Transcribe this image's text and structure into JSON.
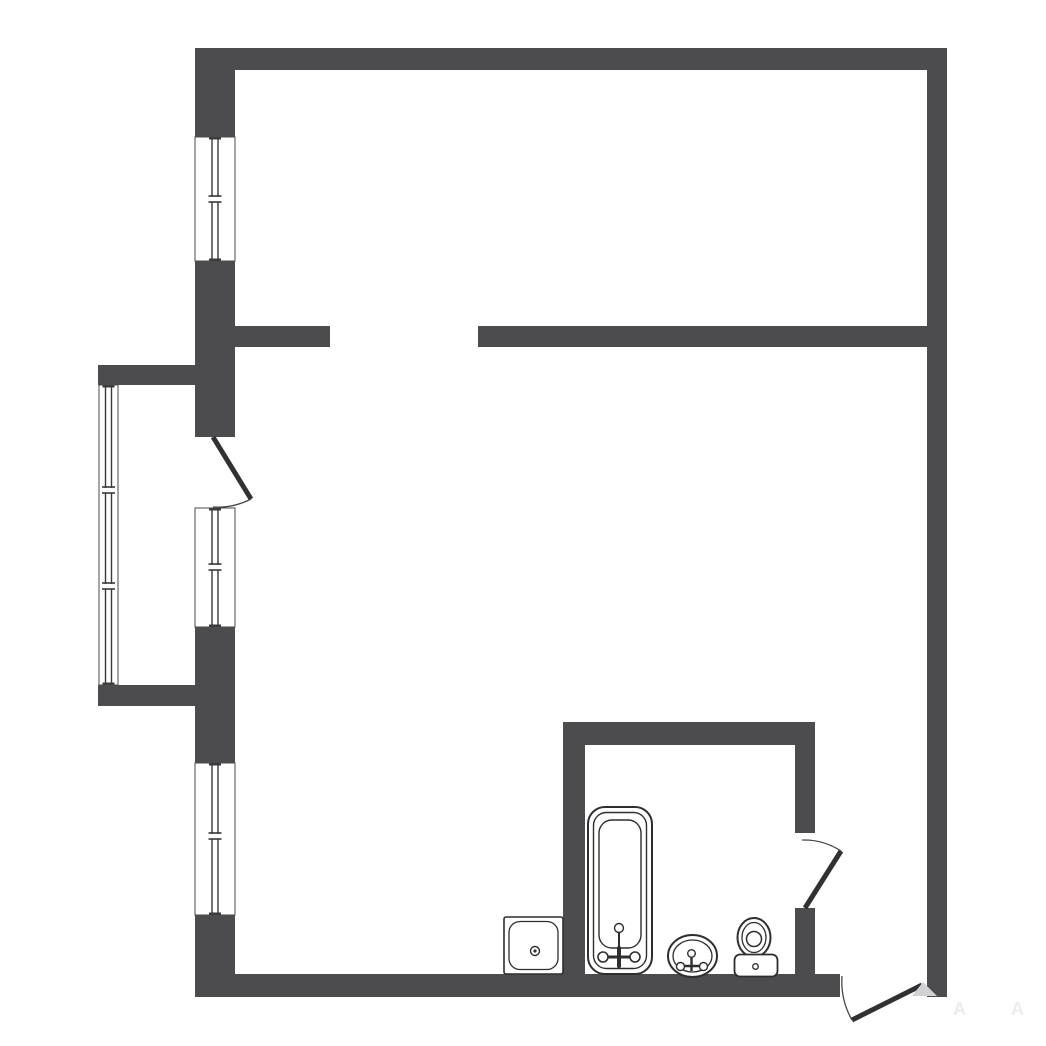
{
  "document": {
    "kind": "apartment-floor-plan",
    "description": "Black-and-white architectural floor plan of a one-room apartment with balcony, bathroom and entrance hall"
  },
  "canvas": {
    "width": 1046,
    "height": 1046,
    "background": "#ffffff"
  },
  "colors": {
    "wall": "#4c4c4e",
    "fixture_line": "#2e2e30",
    "window_line": "#39393b",
    "window_border": "#4a4a4c",
    "door_leaf": "#313133",
    "door_swing": "#47474a",
    "notch": "#d2d2d4",
    "watermark": "#ececec",
    "background": "#ffffff"
  },
  "plan": {
    "walls": [
      {
        "name": "wall-top",
        "x": 195,
        "y": 48,
        "w": 752,
        "h": 22
      },
      {
        "name": "wall-right",
        "x": 927,
        "y": 48,
        "w": 20,
        "h": 949
      },
      {
        "name": "wall-bottom",
        "x": 195,
        "y": 974,
        "w": 645,
        "h": 23
      },
      {
        "name": "wall-left-upper",
        "x": 195,
        "y": 48,
        "w": 40,
        "h": 89
      },
      {
        "name": "wall-left-mid",
        "x": 195,
        "y": 261,
        "w": 40,
        "h": 176
      },
      {
        "name": "wall-left-lower",
        "x": 195,
        "y": 627,
        "w": 40,
        "h": 136
      },
      {
        "name": "wall-left-bottom",
        "x": 195,
        "y": 915,
        "w": 40,
        "h": 82
      },
      {
        "name": "partition-left",
        "x": 235,
        "y": 326,
        "w": 95,
        "h": 21
      },
      {
        "name": "partition-right",
        "x": 478,
        "y": 326,
        "w": 449,
        "h": 21
      },
      {
        "name": "balcony-stub-top",
        "x": 98,
        "y": 365,
        "w": 97,
        "h": 20
      },
      {
        "name": "balcony-stub-bottom",
        "x": 98,
        "y": 685,
        "w": 97,
        "h": 21
      },
      {
        "name": "bathroom-wall-left",
        "x": 563,
        "y": 722,
        "w": 22,
        "h": 252
      },
      {
        "name": "bathroom-wall-top",
        "x": 563,
        "y": 722,
        "w": 252,
        "h": 23
      },
      {
        "name": "bathroom-wall-right-upper",
        "x": 795,
        "y": 722,
        "w": 20,
        "h": 111
      },
      {
        "name": "bathroom-wall-right-lower",
        "x": 795,
        "y": 908,
        "w": 20,
        "h": 66
      }
    ],
    "windows": [
      {
        "name": "window-top-room",
        "x": 195,
        "y": 137,
        "w": 40,
        "h": 124,
        "ticks": [
          196
        ]
      },
      {
        "name": "window-balcony-door",
        "x": 195,
        "y": 508,
        "w": 40,
        "h": 119,
        "ticks": [
          564
        ]
      },
      {
        "name": "window-living-room",
        "x": 195,
        "y": 763,
        "w": 40,
        "h": 152,
        "ticks": [
          833
        ]
      },
      {
        "name": "balcony-glazing",
        "x": 99,
        "y": 385,
        "w": 19,
        "h": 300,
        "ticks": [
          487,
          583
        ]
      }
    ],
    "doors": [
      {
        "name": "balcony-door",
        "hinge": [
          213,
          437
        ],
        "tip": [
          251,
          499
        ],
        "jamb": [
          213,
          507
        ],
        "sweep": 1
      },
      {
        "name": "bathroom-door",
        "hinge": [
          805,
          908
        ],
        "tip": [
          841,
          851
        ],
        "jamb": [
          802,
          840
        ],
        "sweep": 0
      },
      {
        "name": "entrance-door",
        "hinge": [
          922,
          985
        ],
        "tip": [
          852,
          1020
        ],
        "jamb": [
          842,
          976
        ],
        "sweep": 1
      }
    ],
    "door_notch": {
      "name": "entrance-door-notch",
      "points": "912,996 937,996 923,982"
    },
    "fixtures": [
      {
        "name": "kitchen-sink",
        "shapes": [
          {
            "t": "rect",
            "x": 504,
            "y": 917,
            "w": 59,
            "h": 57,
            "rx": 2,
            "sw": 1.6
          },
          {
            "t": "rect",
            "x": 509,
            "y": 921.5,
            "w": 49,
            "h": 48,
            "rx": 11,
            "sw": 1.3
          },
          {
            "t": "circle",
            "cx": 535,
            "cy": 951,
            "r": 4.5,
            "sw": 1.4
          },
          {
            "t": "dot",
            "cx": 535,
            "cy": 951,
            "r": 1.6
          }
        ]
      },
      {
        "name": "bathtub",
        "shapes": [
          {
            "t": "rect",
            "x": 588,
            "y": 807,
            "w": 64,
            "h": 167,
            "rx": 17,
            "sw": 2
          },
          {
            "t": "rect",
            "x": 593.5,
            "y": 812.5,
            "w": 53,
            "h": 156,
            "rx": 13,
            "sw": 1.4
          },
          {
            "t": "rect",
            "x": 599,
            "y": 820,
            "w": 42,
            "h": 128,
            "rx": 13,
            "sw": 1.4
          },
          {
            "t": "circle",
            "cx": 619,
            "cy": 928,
            "r": 4.5,
            "sw": 1.4
          },
          {
            "t": "line",
            "x1": 619,
            "y1": 933,
            "x2": 619,
            "y2": 969,
            "sw": 2
          },
          {
            "t": "line",
            "x1": 619,
            "y1": 948,
            "x2": 619,
            "y2": 966,
            "sw": 4,
            "cap": "round"
          },
          {
            "t": "line",
            "x1": 604,
            "y1": 957,
            "x2": 634,
            "y2": 957,
            "sw": 3
          },
          {
            "t": "circle",
            "cx": 603,
            "cy": 957,
            "r": 5,
            "sw": 1.6
          },
          {
            "t": "circle",
            "cx": 635,
            "cy": 957,
            "r": 5,
            "sw": 1.6
          }
        ]
      },
      {
        "name": "wash-basin",
        "shapes": [
          {
            "t": "ellipse",
            "cx": 692.5,
            "cy": 956,
            "rx": 24.5,
            "ry": 21,
            "sw": 2
          },
          {
            "t": "ellipse",
            "cx": 692.5,
            "cy": 956,
            "rx": 19.5,
            "ry": 16,
            "sw": 1.3
          },
          {
            "t": "line",
            "x1": 691.5,
            "y1": 950,
            "x2": 691.5,
            "y2": 971,
            "sw": 2.4
          },
          {
            "t": "circle",
            "cx": 691.5,
            "cy": 953.5,
            "r": 3.8,
            "sw": 1.4
          },
          {
            "t": "line",
            "x1": 681,
            "y1": 966,
            "x2": 703,
            "y2": 966,
            "sw": 2.4
          },
          {
            "t": "circle",
            "cx": 680.5,
            "cy": 966.5,
            "r": 4,
            "sw": 1.4
          },
          {
            "t": "circle",
            "cx": 703.5,
            "cy": 966.5,
            "r": 4,
            "sw": 1.4
          }
        ]
      },
      {
        "name": "toilet",
        "shapes": [
          {
            "t": "ellipse",
            "cx": 754,
            "cy": 937.5,
            "rx": 16.5,
            "ry": 19.5,
            "sw": 2
          },
          {
            "t": "ellipse",
            "cx": 754,
            "cy": 937.5,
            "rx": 12,
            "ry": 15,
            "sw": 1.3
          },
          {
            "t": "circle",
            "cx": 754,
            "cy": 939,
            "r": 7.5,
            "sw": 1.5
          },
          {
            "t": "rect",
            "x": 734.5,
            "y": 954.5,
            "w": 43,
            "h": 22,
            "rx": 5.5,
            "sw": 1.8
          },
          {
            "t": "circle",
            "cx": 755.5,
            "cy": 966.5,
            "r": 2.8,
            "sw": 1.3
          }
        ]
      }
    ]
  },
  "watermarks": [
    {
      "text": "A",
      "x": 953,
      "y": 1015
    },
    {
      "text": "A",
      "x": 1011,
      "y": 1015
    }
  ]
}
